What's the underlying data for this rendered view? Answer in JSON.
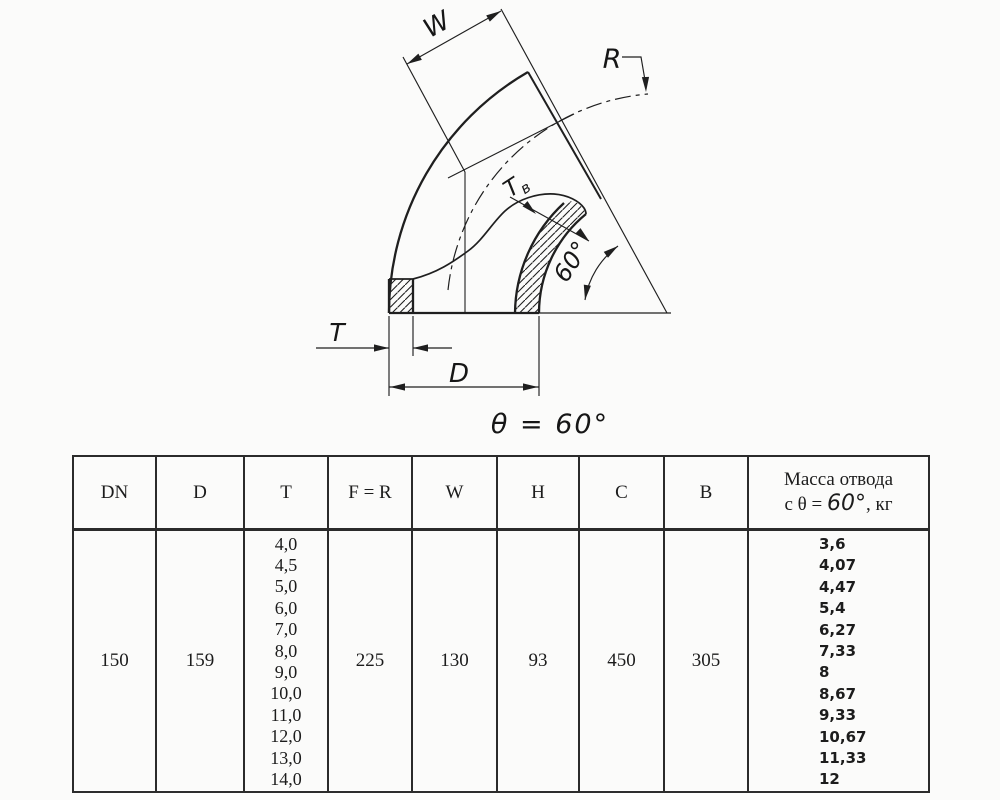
{
  "colors": {
    "ink": "#1f1f1f",
    "paper": "#fbfbfa",
    "table_border": "#2b2b2b"
  },
  "drawing": {
    "labels": {
      "w": "W",
      "r": "R",
      "t": "T",
      "d": "D",
      "tv_main": "Т",
      "tv_sub": "в",
      "bend_angle": "60°",
      "caption": "θ = 60°"
    }
  },
  "table": {
    "headers": [
      "DN",
      "D",
      "T",
      "F = R",
      "W",
      "H",
      "C",
      "B"
    ],
    "mass_header": {
      "line1": "Масса отвода",
      "prefix": "с θ = ",
      "angle": "60°",
      "suffix": ", кг"
    },
    "row": {
      "dn": "150",
      "d": "159",
      "t_values": [
        "4,0",
        "4,5",
        "5,0",
        "6,0",
        "7,0",
        "8,0",
        "9,0",
        "10,0",
        "11,0",
        "12,0",
        "13,0",
        "14,0"
      ],
      "f_r": "225",
      "w": "130",
      "h": "93",
      "c": "450",
      "b": "305",
      "mass_values": [
        "3,6",
        "4,07",
        "4,47",
        "5,4",
        "6,27",
        "7,33",
        "8",
        "8,67",
        "9,33",
        "10,67",
        "11,33",
        "12"
      ]
    }
  }
}
